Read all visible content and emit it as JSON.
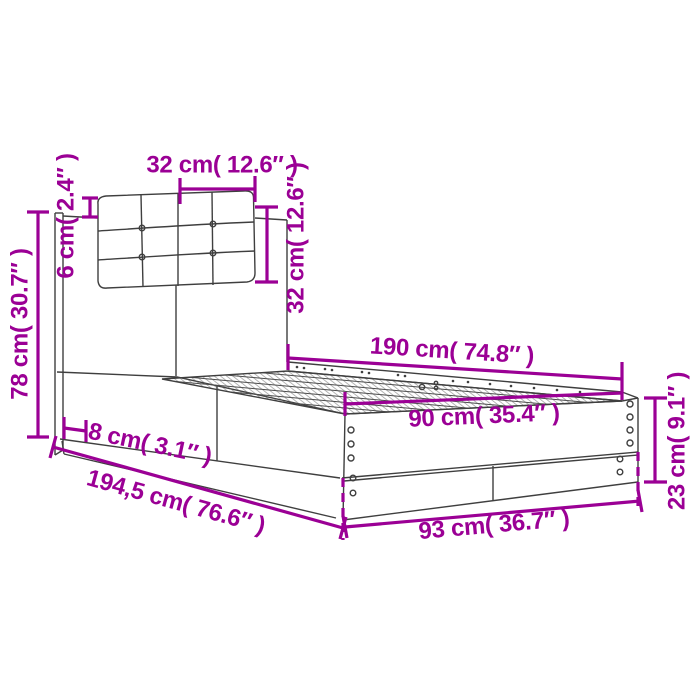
{
  "colors": {
    "dimension_annotation": "#9B0095",
    "line_art": "#3F3F3F",
    "background": "#FFFFFF"
  },
  "dimensions": {
    "cushion_width_top": "32 cm( 12.6″ )",
    "cushion_overhang_left": "6 cm( 2.4″ )",
    "headboard_height_left": "78 cm( 30.7″ )",
    "cushion_height_right": "32 cm( 12.6″ )",
    "slat_area_length": "190 cm( 74.8″ )",
    "slat_area_width": "90 cm( 35.4″ )",
    "frame_height_right": "23 cm( 9.1″ )",
    "headboard_thickness": "8 cm( 3.1″ )",
    "total_length_bottom": "194,5 cm( 76.6″ )",
    "frame_width_bottom": "93 cm( 36.7″ )"
  }
}
